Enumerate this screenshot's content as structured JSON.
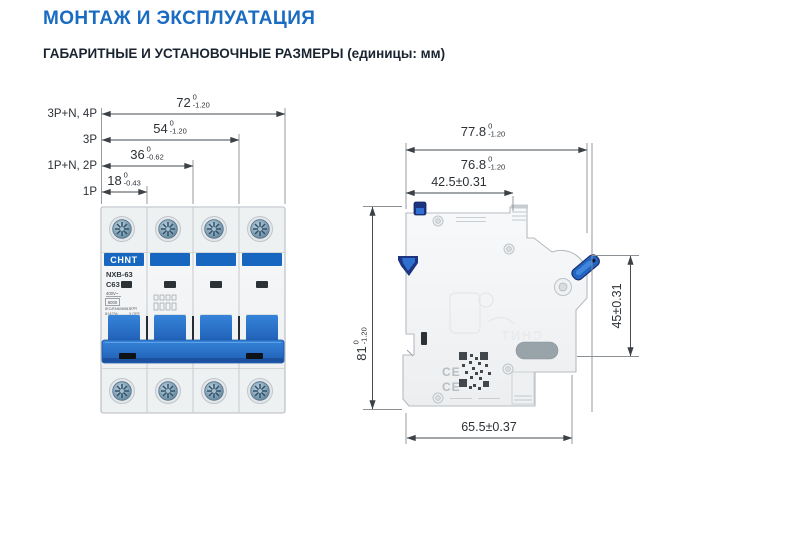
{
  "header": {
    "title": "МОНТАЖ И ЭКСПЛУАТАЦИЯ",
    "subtitle": "ГАБАРИТНЫЕ И УСТАНОВОЧНЫЕ РАЗМЕРЫ (единицы: мм)"
  },
  "front_view": {
    "pole_labels": [
      "3P+N, 4P",
      "3P",
      "1P+N, 2P",
      "1P"
    ],
    "dims": [
      {
        "value": "72",
        "upper": "0",
        "lower": "-1.20"
      },
      {
        "value": "54",
        "upper": "0",
        "lower": "-1.20"
      },
      {
        "value": "36",
        "upper": "0",
        "lower": "-0.62"
      },
      {
        "value": "18",
        "upper": "0",
        "lower": "-0.43"
      }
    ],
    "device": {
      "brand": "CHNT",
      "model": "NXB-63",
      "rating": "C63",
      "voltage": "400V~",
      "capacity": "6000",
      "standard": "IEC/EN60898-1",
      "code": "814254",
      "on": "I ON",
      "off": "0 OFF"
    }
  },
  "side_view": {
    "dims": {
      "overall_width": {
        "value": "77.8",
        "upper": "0",
        "lower": "-1.20"
      },
      "body_width": {
        "value": "76.8",
        "upper": "0",
        "lower": "-1.20"
      },
      "mounting": "42.5±0.31",
      "height": {
        "value": "81",
        "upper": "0",
        "lower": "-1.20"
      },
      "din": "45±0.31",
      "depth": "65.5±0.37"
    },
    "ce_mark": "CE",
    "watermark": "CHNT"
  },
  "colors": {
    "accent_blue": "#1a6bc2",
    "heading_dark": "#1a2430",
    "breaker_blue": "#2470cc",
    "clip_navy": "#1d3580",
    "dim_line": "#474c51"
  }
}
